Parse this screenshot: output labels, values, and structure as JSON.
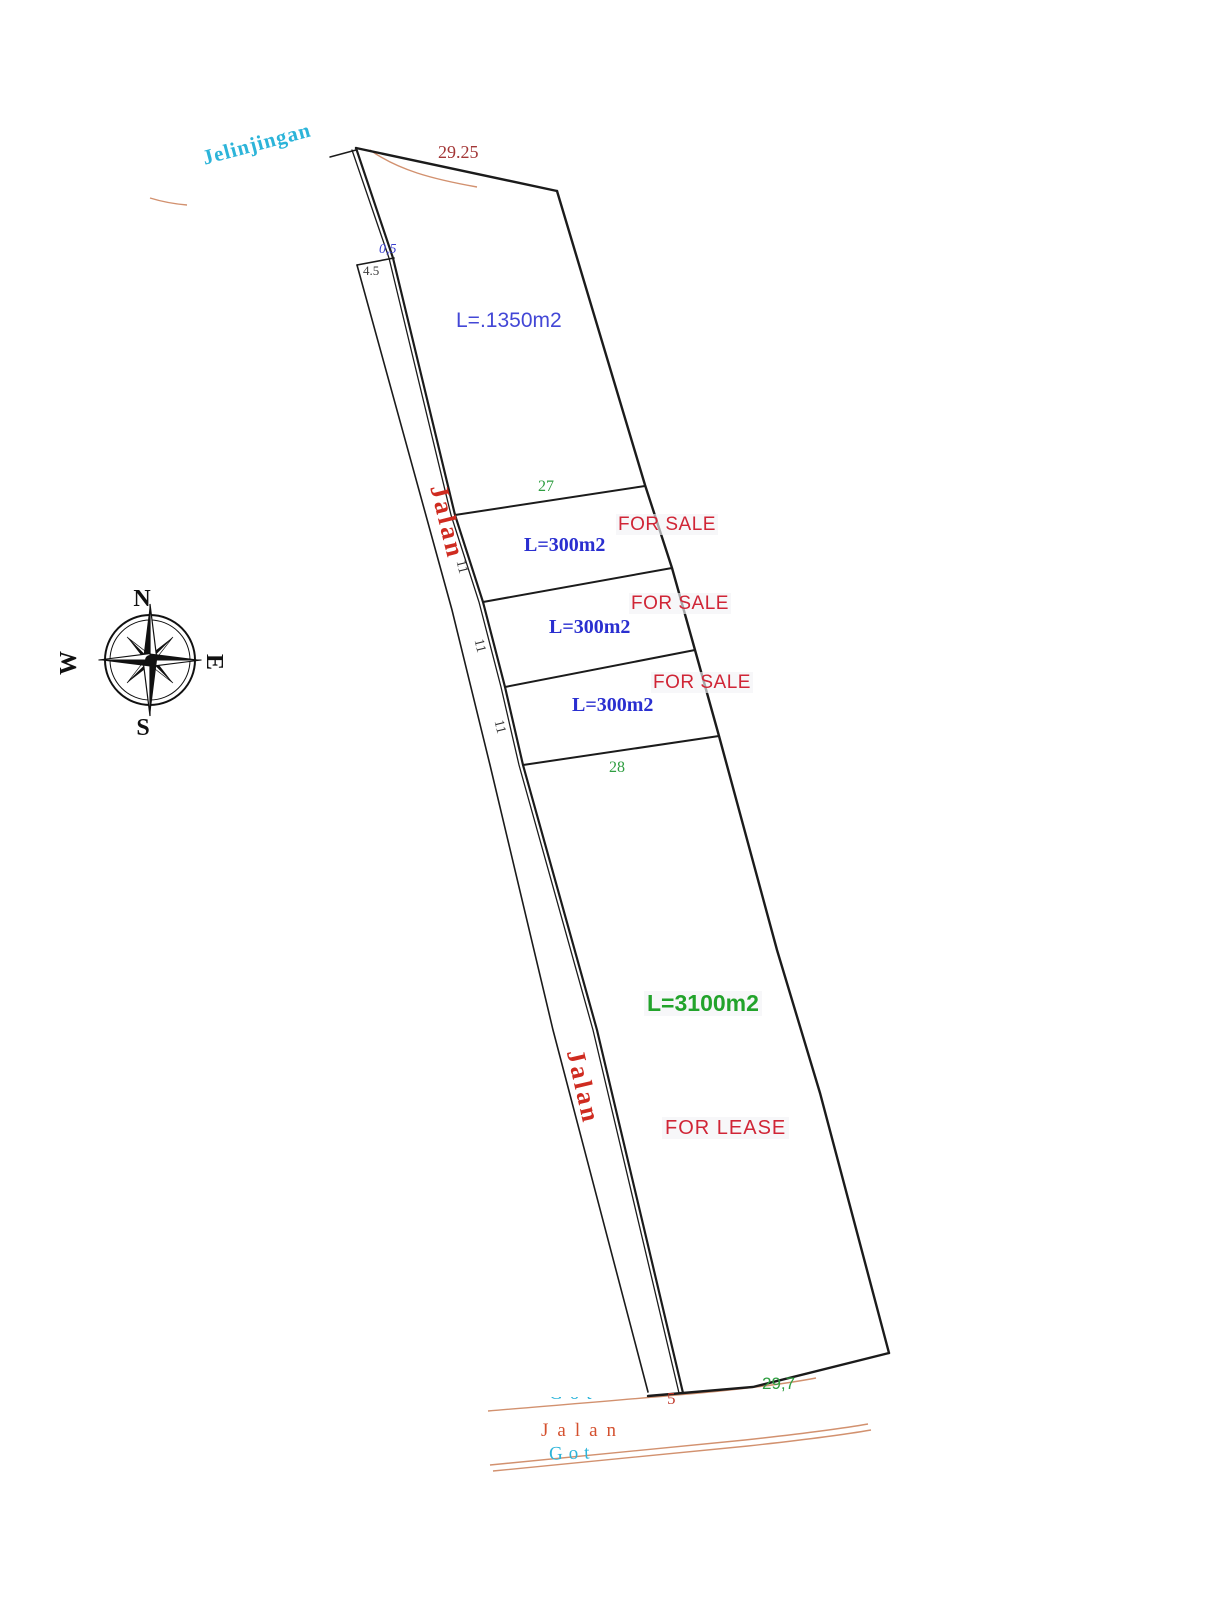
{
  "compass": {
    "north": "N",
    "east": "E",
    "south": "S",
    "west": "W"
  },
  "streets": {
    "north_street": "Jelinjingan",
    "west_road_upper": "Jalan",
    "west_road_lower": "Jalan",
    "south_road": "Jalan",
    "south_ditch": "Got",
    "south_ditch_partial": "Got"
  },
  "dimensions": {
    "north_boundary": "29.25",
    "road_gap": "0,5",
    "road_top_width": "4.5",
    "sale_top_width": "27",
    "sale_bottom_width": "28",
    "sale_side_1": "11",
    "sale_side_2": "11",
    "sale_side_3": "11",
    "south_boundary": "29,7",
    "south_offset": "5"
  },
  "parcels": {
    "north": {
      "area": "L=.1350m2"
    },
    "sale": [
      {
        "area": "L=300m2",
        "status": "FOR SALE"
      },
      {
        "area": "L=300m2",
        "status": "FOR SALE"
      },
      {
        "area": "L=300m2",
        "status": "FOR SALE"
      }
    ],
    "lease": {
      "area": "L=3100m2",
      "status": "FOR LEASE"
    }
  },
  "colors": {
    "boundary_black": "#1b1b1b",
    "area_blue": "#2a2fd0",
    "sale_red": "#d02536",
    "dim_green": "#2f9e41",
    "lease_green": "#22a32b",
    "road_label_red": "#cf2b20",
    "street_cyan": "#2cb4d9",
    "dim_maroon": "#a33636",
    "contour_orange": "#d2916f",
    "south_road_orange": "#d4502e"
  }
}
